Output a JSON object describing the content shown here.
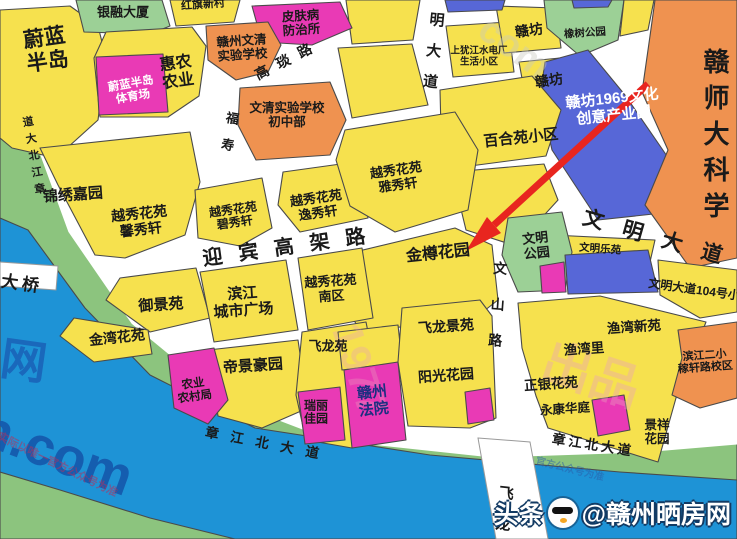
{
  "map": {
    "colors": {
      "block_yellow": "#F6E14E",
      "park_green": "#9CD096",
      "bank_green": "#8CC47E",
      "river_blue": "#1E93D6",
      "blue_block": "#5767D7",
      "magenta": "#E93AB5",
      "orange": "#EF9250",
      "road_white": "#FFFFFF",
      "outline": "#4A4A4A",
      "arrow_red": "#E8251F"
    },
    "blocks": [
      {
        "n": "weilan-bandao",
        "lines": [
          "蔚蓝",
          "半岛"
        ],
        "x": 46,
        "y": 50,
        "s": 21,
        "r": -8
      },
      {
        "n": "yinrong-dasha",
        "lines": [
          "银融大厦"
        ],
        "x": 123,
        "y": 13,
        "s": 13,
        "r": 0
      },
      {
        "n": "hongqi-xincun",
        "lines": [
          "红旗新村"
        ],
        "x": 203,
        "y": 5,
        "s": 11,
        "r": -4
      },
      {
        "n": "huinong-nongye",
        "lines": [
          "惠农",
          "农业"
        ],
        "x": 177,
        "y": 73,
        "s": 16,
        "r": -8
      },
      {
        "n": "weilan-tiyuchang",
        "lines": [
          "蔚蓝半岛",
          "体育场"
        ],
        "x": 132,
        "y": 91,
        "s": 11.5,
        "r": -10,
        "c": "#ffffff"
      },
      {
        "n": "pifubing-fangzhisuo",
        "lines": [
          "皮肤病",
          "防治所"
        ],
        "x": 301,
        "y": 23,
        "s": 12.5,
        "r": -4
      },
      {
        "n": "ganzhou-wenqing-shiyan-xuexiao",
        "lines": [
          "赣州文清",
          "实验学校"
        ],
        "x": 242,
        "y": 48,
        "s": 12.5,
        "r": -4
      },
      {
        "n": "wenqing-shiyan-chuzhongbu",
        "lines": [
          "文清实验学校",
          "初中部"
        ],
        "x": 287,
        "y": 115,
        "s": 12.5,
        "r": 0
      },
      {
        "n": "shangyoujiang-shenghuo-xiaoqu",
        "lines": [
          "上犹江水电厂",
          "生活小区"
        ],
        "x": 479,
        "y": 57,
        "s": 9.5,
        "r": 0
      },
      {
        "n": "ganfang-north",
        "lines": [
          "赣坊"
        ],
        "x": 529,
        "y": 31,
        "s": 14,
        "r": -8
      },
      {
        "n": "ganfang-south",
        "lines": [
          "赣坊"
        ],
        "x": 549,
        "y": 81,
        "s": 14,
        "r": -8
      },
      {
        "n": "xiangshu-gongyuan",
        "lines": [
          "橡树公园"
        ],
        "x": 585,
        "y": 34,
        "s": 10.5,
        "r": -4
      },
      {
        "n": "ganfang-1969",
        "lines": [
          "赣坊1969文化",
          "创意产业园"
        ],
        "x": 613,
        "y": 108,
        "s": 15,
        "r": -6,
        "c": "#ffffff"
      },
      {
        "n": "ganshida-kexue",
        "lines": [
          "赣师大科学"
        ],
        "x": 715,
        "y": 138,
        "s": 26,
        "r": 0,
        "v": true,
        "ls": 10,
        "w": 900
      },
      {
        "n": "baiheyuan-xiaoqu",
        "lines": [
          "百合苑小区"
        ],
        "x": 521,
        "y": 139,
        "s": 15,
        "r": -6
      },
      {
        "n": "jinxiu-jiayuan",
        "lines": [
          "锦绣嘉园"
        ],
        "x": 73,
        "y": 196,
        "s": 15,
        "r": -4
      },
      {
        "n": "yuexiu-xinxiuxuan",
        "lines": [
          "越秀花苑",
          "馨秀轩"
        ],
        "x": 140,
        "y": 222,
        "s": 14,
        "r": -6
      },
      {
        "n": "yuexiu-bixiuxuan",
        "lines": [
          "越秀花苑",
          "碧秀轩"
        ],
        "x": 234,
        "y": 217,
        "s": 12,
        "r": -8
      },
      {
        "n": "yuexiu-yixiuxuan",
        "lines": [
          "越秀花苑",
          "逸秀轩"
        ],
        "x": 317,
        "y": 206,
        "s": 13,
        "r": -8
      },
      {
        "n": "yuexiu-yaxiuxuan",
        "lines": [
          "越秀花苑",
          "雅秀轩"
        ],
        "x": 397,
        "y": 178,
        "s": 13,
        "r": -8
      },
      {
        "n": "jinzun-huayuan",
        "lines": [
          "金樽花园"
        ],
        "x": 438,
        "y": 254,
        "s": 16,
        "r": -6
      },
      {
        "n": "wenming-gongyuan",
        "lines": [
          "文明",
          "公园"
        ],
        "x": 536,
        "y": 246,
        "s": 13,
        "r": -6
      },
      {
        "n": "wenming-leyuan",
        "lines": [
          "文明乐苑"
        ],
        "x": 600,
        "y": 250,
        "s": 10.5,
        "r": 4
      },
      {
        "n": "yujingyuan",
        "lines": [
          "御景苑"
        ],
        "x": 161,
        "y": 306,
        "s": 15,
        "r": -4
      },
      {
        "n": "binjiang-chengshi-guangchang",
        "lines": [
          "滨江",
          "城市广场"
        ],
        "x": 243,
        "y": 303,
        "s": 15,
        "r": -4
      },
      {
        "n": "yuexiu-nanqu",
        "lines": [
          "越秀花苑",
          "南区"
        ],
        "x": 331,
        "y": 289,
        "s": 13,
        "r": -4
      },
      {
        "n": "jinwan-huayuan",
        "lines": [
          "金湾花苑"
        ],
        "x": 117,
        "y": 338,
        "s": 14,
        "r": -6
      },
      {
        "n": "dijing-haoyuan",
        "lines": [
          "帝景豪园"
        ],
        "x": 253,
        "y": 367,
        "s": 15,
        "r": -4
      },
      {
        "n": "nongye-nongcunju",
        "lines": [
          "农业",
          "农村局"
        ],
        "x": 194,
        "y": 391,
        "s": 11.5,
        "r": -8
      },
      {
        "n": "feilongyuan",
        "lines": [
          "飞龙苑"
        ],
        "x": 328,
        "y": 347,
        "s": 13,
        "r": 0
      },
      {
        "n": "ruili-jiayuan",
        "lines": [
          "瑞丽",
          "佳园"
        ],
        "x": 316,
        "y": 413,
        "s": 12,
        "r": 0
      },
      {
        "n": "ganzhou-fayuan",
        "lines": [
          "赣州",
          "法院"
        ],
        "x": 373,
        "y": 402,
        "s": 15,
        "r": -6,
        "c": "#1c2f80"
      },
      {
        "n": "feilong-jingyuan",
        "lines": [
          "飞龙景苑"
        ],
        "x": 446,
        "y": 327,
        "s": 14,
        "r": -4
      },
      {
        "n": "yangguang-huayuan",
        "lines": [
          "阳光花园"
        ],
        "x": 446,
        "y": 376,
        "s": 14,
        "r": -4
      },
      {
        "n": "zhengyin-huayuan",
        "lines": [
          "正银花苑"
        ],
        "x": 551,
        "y": 384,
        "s": 13.5,
        "r": -4
      },
      {
        "n": "yongkang-huating",
        "lines": [
          "永康华庭"
        ],
        "x": 565,
        "y": 409,
        "s": 12.5,
        "r": -4
      },
      {
        "n": "yuwanli",
        "lines": [
          "渔湾里"
        ],
        "x": 584,
        "y": 349,
        "s": 13.5,
        "r": -4
      },
      {
        "n": "yuwan-xinyuan",
        "lines": [
          "渔湾新苑"
        ],
        "x": 634,
        "y": 327,
        "s": 13.5,
        "r": -4
      },
      {
        "n": "jingxiang-huayuan",
        "lines": [
          "景祥",
          "花园"
        ],
        "x": 657,
        "y": 432,
        "s": 12.5,
        "r": 0
      },
      {
        "n": "binjiang-erxiao-jiaxuanlu",
        "lines": [
          "滨江二小",
          "稼轩路校区"
        ],
        "x": 705,
        "y": 362,
        "s": 11,
        "r": -4
      },
      {
        "n": "wenmingdadao-104-xiaoqu",
        "lines": [
          "文明大道104号小区"
        ],
        "x": 700,
        "y": 291,
        "s": 12,
        "r": 8
      }
    ],
    "roads": [
      {
        "n": "zhangjiang-beidadao-west",
        "text": "章江北大道",
        "x": 33,
        "y": 158,
        "s": 11,
        "r": -10,
        "v": true,
        "ls": 6,
        "rev": true
      },
      {
        "n": "daqiao",
        "text": "大桥",
        "x": 22,
        "y": 284,
        "s": 17,
        "r": 8,
        "ls": 4
      },
      {
        "n": "yingbin-gaojialu",
        "text": "迎宾高架路",
        "x": 292,
        "y": 247,
        "s": 20,
        "r": -8,
        "ls": 16
      },
      {
        "n": "gaoyanlu",
        "text": "高琰路",
        "x": 288,
        "y": 60,
        "s": 14,
        "r": -27,
        "ls": 10
      },
      {
        "n": "fushoulu",
        "text": "福寿",
        "x": 228,
        "y": 138,
        "s": 13,
        "r": 10,
        "v": true,
        "ls": 14
      },
      {
        "n": "mingdadao",
        "text": "明大道",
        "x": 432,
        "y": 58,
        "s": 15,
        "r": 6,
        "v": true,
        "ls": 16
      },
      {
        "n": "wenming-dadao",
        "text": "文明大道",
        "x": 662,
        "y": 240,
        "s": 21,
        "r": 16,
        "ls": 20
      },
      {
        "n": "wenshanlu",
        "text": "文山路",
        "x": 497,
        "y": 315,
        "s": 14,
        "r": 4,
        "v": true,
        "ls": 22
      },
      {
        "n": "zhangjiang-beidadao-south1",
        "text": "章江北大道",
        "x": 268,
        "y": 444,
        "s": 13.5,
        "r": 11,
        "ls": 12
      },
      {
        "n": "zhangjiang-beidadao-south2",
        "text": "章江北大道",
        "x": 593,
        "y": 445,
        "s": 13.5,
        "r": 9,
        "ls": 3
      },
      {
        "n": "feilong-daqiao",
        "text": "飞龙",
        "x": 503,
        "y": 516,
        "s": 15,
        "r": 6,
        "v": true,
        "ls": 16
      }
    ],
    "watermarks": [
      {
        "n": "wm-wang",
        "text": "网",
        "x": 6,
        "y": 322,
        "s": 46,
        "r": 8,
        "c": "#1a63b8",
        "o": 0.88
      },
      {
        "n": "wm-ncom",
        "text": "n.com",
        "x": -8,
        "y": 396,
        "s": 54,
        "r": 20,
        "c": "#1558ab",
        "o": 0.9
      },
      {
        "n": "wm-chupin",
        "text": "出品",
        "x": 556,
        "y": 322,
        "s": 50,
        "r": 18,
        "c": "#e9a0bd",
        "o": 0.38
      },
      {
        "n": "wm-1977",
        "text": "1977",
        "x": 368,
        "y": 318,
        "s": 42,
        "r": 72,
        "c": "#e9a0bd",
        "o": 0.32
      },
      {
        "n": "wm-disclaimer",
        "text": "实际以唯一官方公众号为准",
        "x": 2,
        "y": 428,
        "s": 11,
        "r": 26,
        "c": "#b3315e",
        "o": 0.55
      },
      {
        "n": "wm-gongzhonghao",
        "text": "官方公众号为准",
        "x": 538,
        "y": 452,
        "s": 10,
        "r": 14,
        "c": "#2a5ca8",
        "o": 0.5
      },
      {
        "n": "wm-com-top",
        "text": "com",
        "x": 495,
        "y": 8,
        "s": 38,
        "r": 36,
        "c": "#c9c9bf",
        "o": 0.4
      }
    ],
    "logo": {
      "prefix": "头条",
      "handle": "@赣州晒房网",
      "icon": "mascot-face-icon"
    },
    "annotation": {
      "arrow_points_to": "金樽花园",
      "arrow_color": "#E8251F"
    }
  }
}
